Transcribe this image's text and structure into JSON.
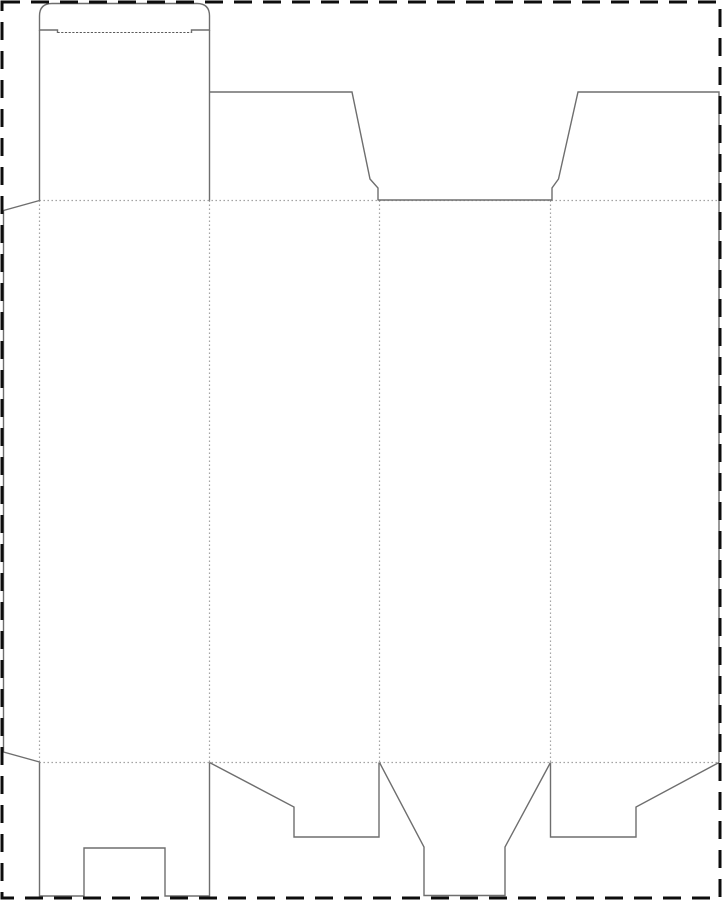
{
  "canvas": {
    "width": 722,
    "height": 900,
    "background": "#ffffff"
  },
  "line_styles": {
    "cut": {
      "color": "#6e6e6e",
      "width": 1.4,
      "dash": ""
    },
    "fold": {
      "color": "#9a9a9a",
      "width": 1.2,
      "dash": "1.4 2.6"
    },
    "fold_fine": {
      "color": "#5a5a5a",
      "width": 1.1,
      "dash": "2.2 1.5"
    },
    "border": {
      "color": "#0d0d0d",
      "width": 3,
      "dash": "18 11"
    }
  },
  "sheet_border": {
    "name": "sheet-boundary-dashed",
    "x": 2,
    "y": 2,
    "width": 718,
    "height": 896
  },
  "paths": [
    {
      "name": "fold-top-horizontal",
      "style": "fold",
      "d": "M 39.5 200.5 L 719 200.5"
    },
    {
      "name": "fold-bottom-horizontal",
      "style": "fold",
      "d": "M 39.5 762.5 L 719 762.5"
    },
    {
      "name": "fold-vertical-glue-tab",
      "style": "fold",
      "d": "M 39.5 200.5 L 39.5 762.5"
    },
    {
      "name": "fold-vertical-panels-1-2",
      "style": "fold",
      "d": "M 209.5 200.5 L 209.5 762.5"
    },
    {
      "name": "fold-vertical-panels-2-3",
      "style": "fold",
      "d": "M 379.5 200.5 L 379.5 762.5"
    },
    {
      "name": "fold-vertical-panels-3-4",
      "style": "fold",
      "d": "M 550.5 200.5 L 550.5 762.5"
    },
    {
      "name": "tuck-flap-fold",
      "style": "fold_fine",
      "d": "M 57.5 32.5 L 191.5 32.5"
    },
    {
      "name": "tuck-flap-outline",
      "style": "cut",
      "d": "M 57.5 33 L 57.5 30 L 39.5 30 L 39.5 16 Q 39.5 3.5 52 3.5 L 197 3.5 Q 209.5 3.5 209.5 16 L 209.5 30 L 191.5 30 L 191.5 33"
    },
    {
      "name": "lid-panel-left-cut",
      "style": "cut",
      "d": "M 39.5 30 L 39.5 200.5"
    },
    {
      "name": "lid-panel-right-cut",
      "style": "cut",
      "d": "M 209.5 30 L 209.5 200.5"
    },
    {
      "name": "dust-flap-left-outline",
      "style": "cut",
      "d": "M 209.5 92 L 352 92 L 370 179 L 378 188 L 378 200.5"
    },
    {
      "name": "front-panel-top-cut",
      "style": "cut",
      "d": "M 378 200 L 552 200"
    },
    {
      "name": "dust-flap-right-outline",
      "style": "cut",
      "d": "M 552 200.5 L 552 188 L 558.5 179 L 578 92 L 719 92 L 719 762.5"
    },
    {
      "name": "glue-tab-outline",
      "style": "cut",
      "d": "M 39.5 200.5 L 3.5 210.5 L 3.5 752 L 39.5 762"
    },
    {
      "name": "bottom-flap-panel-1-notched-outline",
      "style": "cut",
      "d": "M 39.5 762.5 L 39.5 896 L 84 896 L 84 848 L 165 848 L 165 896 L 209.5 896 L 209.5 762.5"
    },
    {
      "name": "bottom-flap-panel-2-step-outline",
      "style": "cut",
      "d": "M 209.5 762.5 L 294 807 L 294 837 L 379 837 L 379 762.5"
    },
    {
      "name": "bottom-flap-panel-3-funnel-outline",
      "style": "cut",
      "d": "M 379.5 762.5 L 424 847 L 424 895.5 L 505 895.5 L 505 847 L 550.5 762.5"
    },
    {
      "name": "bottom-flap-panel-4-step-outline",
      "style": "cut",
      "d": "M 550.5 762.5 L 550.5 837 L 636 837 L 636 807 L 719 762.5"
    }
  ]
}
